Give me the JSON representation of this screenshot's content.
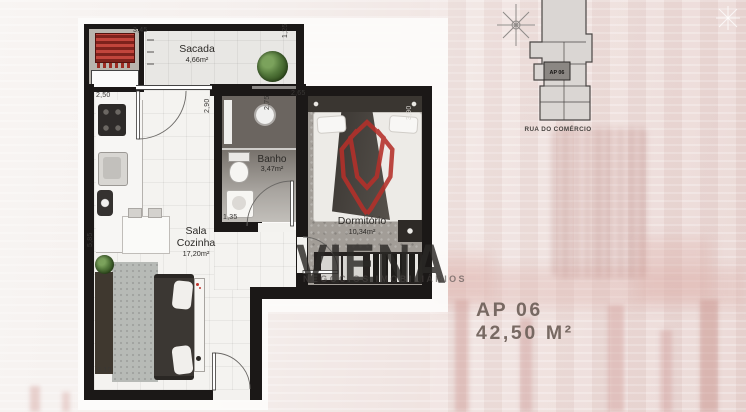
{
  "unit": {
    "number": "AP 06",
    "area": "42,50 M²"
  },
  "key_plan": {
    "unit_label": "AP 06",
    "street": "RUA DO COMÉRCIO"
  },
  "watermark": {
    "brand": "VIENA",
    "tagline": "NEGÓCIOS IMOBILIÁRIOS"
  },
  "rooms": {
    "sacada": {
      "name": "Sacada",
      "area": "4,66m²"
    },
    "banho": {
      "name": "Banho",
      "area": "3,47m²"
    },
    "sala": {
      "line1": "Sala",
      "line2": "Cozinha",
      "area": "17,20m²"
    },
    "dorm": {
      "name": "Dormitório",
      "area": "10,34m²"
    }
  },
  "dims": {
    "sacada_width": "3,45",
    "sacada_depth": "1,25",
    "cozinha_width": "2,50",
    "cozinha_wall": "2,90",
    "sala_height": "5,85",
    "banho_width": "1,35",
    "dorm_wall_left": "2,75",
    "dorm_width": "2,65",
    "dorm_depth": "3,90",
    "sala_width": "3,10"
  },
  "colors": {
    "wall": "#1b1817",
    "logo_red": "#b5302a",
    "unit_text": "#6e6059"
  }
}
